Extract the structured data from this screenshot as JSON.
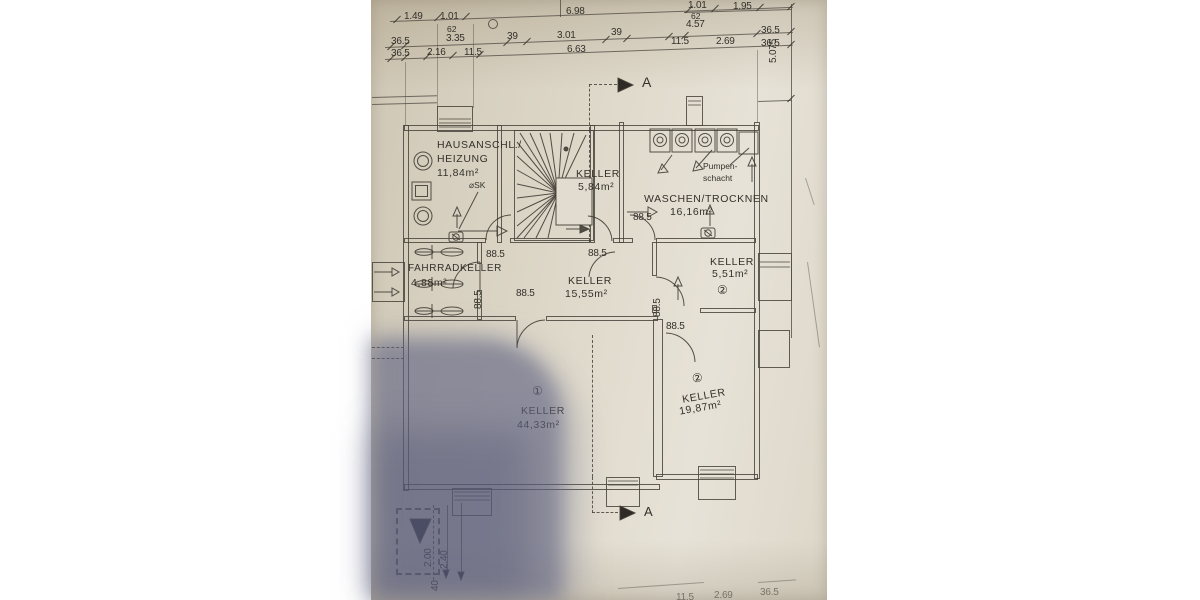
{
  "photo": {
    "background": "#ffffff",
    "paper_color": "#ddd7c9",
    "shadow_color": "#5c6080",
    "line_color": "#54504a"
  },
  "plan": {
    "rooms": [
      {
        "name": "HAUSANSCHL./",
        "name2": "HEIZUNG",
        "area": "11,84m²"
      },
      {
        "name": "KELLER",
        "area": "5,84m²"
      },
      {
        "name": "WASCHEN/TROCKNEN",
        "area": "16,16m²"
      },
      {
        "name": "FAHRRADKELLER",
        "area": "4,88m²"
      },
      {
        "name": "KELLER",
        "area": "15,55m²"
      },
      {
        "name": "KELLER",
        "area": "5,51m²",
        "unit": "②"
      },
      {
        "name": "KELLER",
        "area": "44,33m²",
        "unit": "①"
      },
      {
        "name": "KELLER",
        "area": "19,87m²",
        "unit": "②"
      }
    ],
    "labels": {
      "pump_line1": "Pumpen-",
      "pump_line2": "schacht",
      "sk": "⌀SK",
      "section_marker": "A"
    },
    "dims": [
      "1.01",
      "1.95",
      "1.49",
      "1.01",
      "6.98",
      "62",
      "62",
      "4.57",
      "36.5",
      "5.075",
      "36.5",
      "3.35",
      "39",
      "3.01",
      "39",
      "11.5",
      "2.69",
      "36.5",
      "36.5",
      "2.16",
      "11.5",
      "6.63",
      "88.5",
      "88.5",
      "88.5",
      "88.5",
      "88.5",
      "88.5",
      "88.5",
      "2.00",
      "2.40",
      "40",
      "40",
      "11.5",
      "2.69",
      "36.5"
    ]
  }
}
